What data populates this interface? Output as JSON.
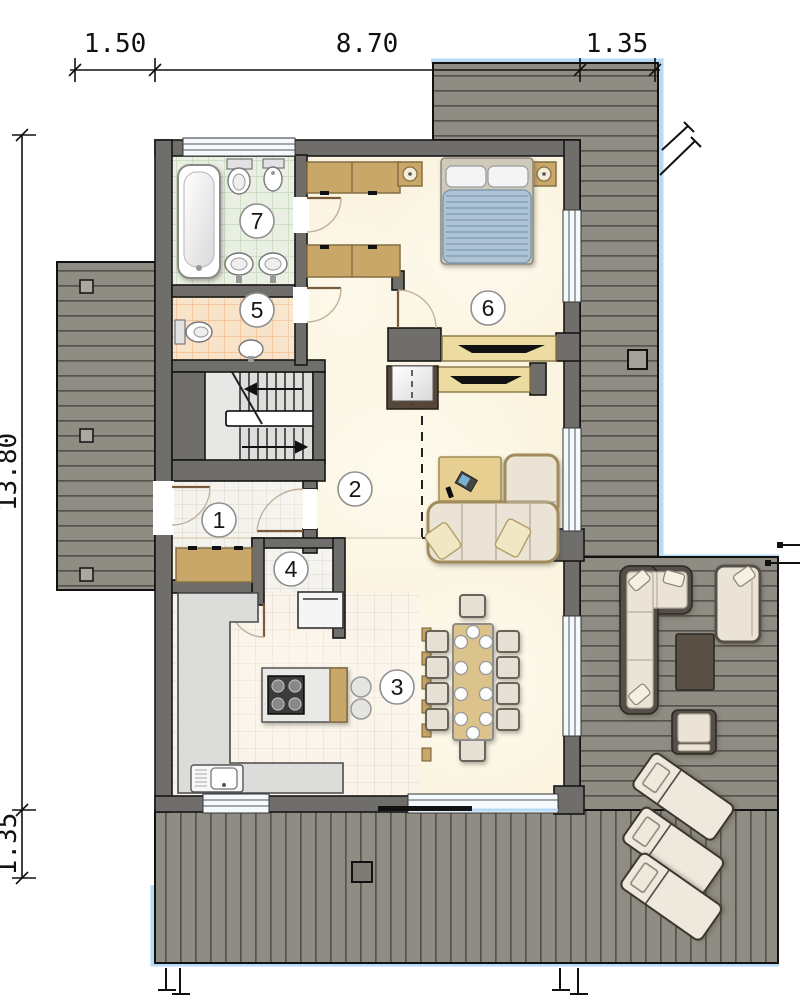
{
  "drawing": {
    "kind": "house ground floor plan",
    "units": "meters"
  },
  "dimensions": {
    "top": [
      {
        "label": "1.50"
      },
      {
        "label": "8.70"
      },
      {
        "label": "1.35"
      }
    ],
    "side": [
      {
        "label": "13.80"
      },
      {
        "label": "1.35"
      }
    ]
  },
  "room_labels": [
    {
      "number": "1",
      "name": "entrance-hall"
    },
    {
      "number": "2",
      "name": "hall-living-room"
    },
    {
      "number": "3",
      "name": "kitchen-dining-room"
    },
    {
      "number": "4",
      "name": "pantry"
    },
    {
      "number": "5",
      "name": "toilet"
    },
    {
      "number": "6",
      "name": "bedroom"
    },
    {
      "number": "7",
      "name": "bathroom"
    }
  ],
  "colors": {
    "deck_gray": "#8f8c83",
    "deck_plank_line": "#55534b",
    "deck_edge_blue": "#b7dbf7",
    "wall_gray": "#6f6e6a",
    "floor_cream": "#fbf4e1",
    "bath_tile_green": "#e9efe2",
    "wc_tile_peach": "#f8e3c9",
    "wood_tan": "#c9a768",
    "duvet_blue": "#aec3d5",
    "counter_gray": "#dcdcda"
  },
  "icons": {
    "bathtub-icon": "rounded rect with inner oval",
    "toilet-icon": "tank rect plus oval bowl",
    "bidet-icon": "small tank plus oval bowl",
    "washbasin-icon": "oval with tap",
    "double-bed-icon": "striped duvet with two pillows",
    "nightstand-lamp-icon": "square with circle lamp",
    "wardrobe-icon": "tan rectangle pair",
    "staircase-icon": "U stair with railing and arrows",
    "fireplace-icon": "dark frame with light box",
    "desk-icon": "tan rect with laptop",
    "corner-sofa-icon": "L shaped cushioned sofa",
    "dining-table-icon": "long table, ten chairs, plates",
    "kitchen-island-icon": "slab with four burner cooktop",
    "kitchen-sink-icon": "double basin with drainer",
    "fridge-icon": "white box with handle",
    "bar-stool-icon": "small circle",
    "outdoor-sofa-icon": "dark frame L sofa",
    "outdoor-armchair-icon": "dark frame chair",
    "coffee-table-icon": "dark rectangle",
    "sun-lounger-icon": "tilted lounger with pillow",
    "deck-post-icon": "small square",
    "foundation-post-icon": "two stakes with feet",
    "slope-marker-icon": "double diagonal ticks"
  }
}
